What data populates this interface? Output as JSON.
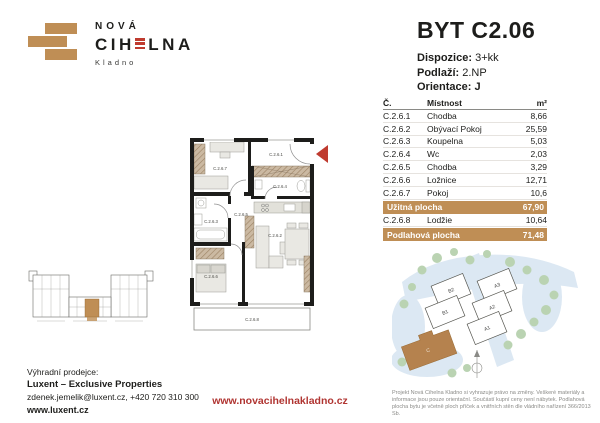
{
  "brand": {
    "name_top": "NOVÁ",
    "name_main_1": "CIH",
    "name_main_2": "LNA",
    "name_sub": "Kladno"
  },
  "colors": {
    "brand_tan": "#bf8e55",
    "accent_red": "#bf3b2f",
    "url_red": "#b03431",
    "wall_black": "#1d1d1b"
  },
  "title": {
    "flat": "BYT C2.06",
    "dispozice_label": "Dispozice:",
    "dispozice_value": "3+kk",
    "podlazi_label": "Podlaží:",
    "podlazi_value": "2.NP",
    "orientace_label": "Orientace:",
    "orientace_value": "J"
  },
  "table": {
    "headers": {
      "no": "Č.",
      "room": "Místnost",
      "area": "m²"
    },
    "rows": [
      {
        "no": "C.2.6.1",
        "room": "Chodba",
        "area": "8,66"
      },
      {
        "no": "C.2.6.2",
        "room": "Obývací Pokoj",
        "area": "25,59"
      },
      {
        "no": "C.2.6.3",
        "room": "Koupelna",
        "area": "5,03"
      },
      {
        "no": "C.2.6.4",
        "room": "Wc",
        "area": "2,03"
      },
      {
        "no": "C.2.6.5",
        "room": "Chodba",
        "area": "3,29"
      },
      {
        "no": "C.2.6.6",
        "room": "Ložnice",
        "area": "12,71"
      },
      {
        "no": "C.2.6.7",
        "room": "Pokoj",
        "area": "10,6"
      }
    ],
    "usable": {
      "label": "Užitná plocha",
      "value": "67,90"
    },
    "lodzie": {
      "no": "C.2.6.8",
      "room": "Lodžie",
      "area": "10,64"
    },
    "floor": {
      "label": "Podlahová plocha",
      "value": "71,48"
    }
  },
  "floorplan": {
    "labels": {
      "r1": "C.2.6.1",
      "r2": "C.2.6.2",
      "r3": "C.2.6.3",
      "r4": "C.2.6.4",
      "r5": "C.2.6.5",
      "r6": "C.2.6.6",
      "r7": "C.2.6.7",
      "r8": "C.2.6.8"
    }
  },
  "siteplan": {
    "labels": {
      "b2": "B2",
      "b1": "B1",
      "a3": "A3",
      "a2": "A2",
      "a1": "A1",
      "c": "C"
    }
  },
  "footer": {
    "seller_label": "Výhradní prodejce:",
    "seller_name": "Luxent – Exclusive Properties",
    "seller_contact": "zdenek.jemelik@luxent.cz, +420 720 310 300",
    "seller_web": "www.luxent.cz",
    "project_web": "www.novacihelnakladno.cz",
    "disclaimer": "Projekt Nová Cihelna Kladno si vyhrazuje právo na změny. Veškeré materiály a informace jsou pouze orientační. Součástí kupní ceny není nábytek. Podlahová plocha bytu je včetně ploch příček a vnitřních stěn dle vládního nařízení 366/2013 Sb."
  }
}
